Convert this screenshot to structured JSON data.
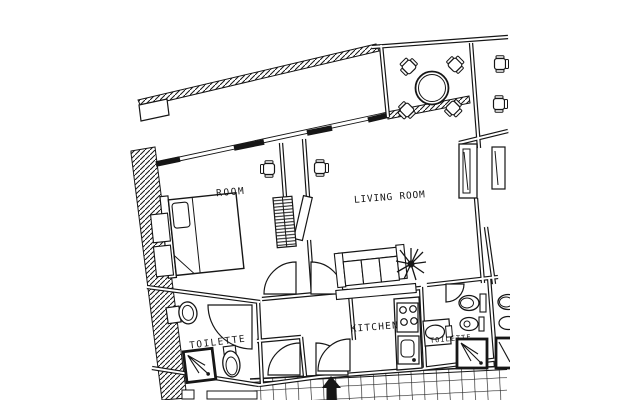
{
  "document": {
    "title": "Apartment floor plan",
    "type": "architectural-floor-plan",
    "style": "monochrome CAD line drawing, photo slightly rotated, cropped at right edge"
  },
  "colors": {
    "paper": "#ffffff",
    "ink": "#161616"
  },
  "rooms": {
    "bedroom": {
      "label": "ROOM"
    },
    "living_room": {
      "label": "LIVING ROOM"
    },
    "kitchen": {
      "label": "KITCHEN"
    },
    "toilette_left": {
      "label": "TOILETTE"
    },
    "toilette_right": {
      "label": "TOILETTE"
    }
  },
  "furniture": [
    "double-bed",
    "pillow",
    "nightstand",
    "wardrobe-shelf",
    "desk-chair",
    "round-dining-table",
    "dining-chair",
    "sofa",
    "console-table",
    "potted-plant",
    "stove-cooktop",
    "kitchen-sink",
    "washbasin",
    "toilet",
    "bidet",
    "shower-cabin",
    "window-panel",
    "door-swing",
    "entrance-arrow",
    "tiled-terrace"
  ]
}
